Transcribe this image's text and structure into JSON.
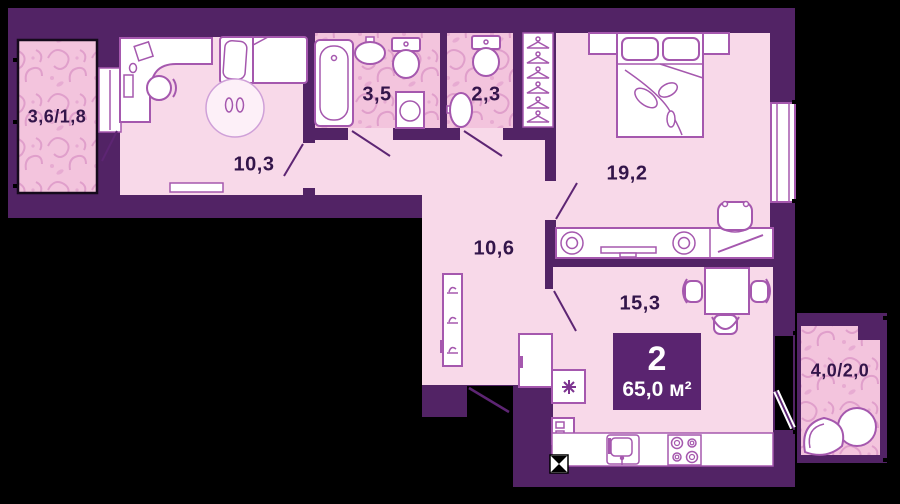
{
  "floorplan": {
    "badge": {
      "rooms_count": "2",
      "total_area": "65,0 м²"
    },
    "rooms": [
      {
        "name": "loggia-left",
        "area_label": "3,6/1,8"
      },
      {
        "name": "living-room",
        "area_label": "10,3"
      },
      {
        "name": "bathroom",
        "area_label": "3,5"
      },
      {
        "name": "toilet",
        "area_label": "2,3"
      },
      {
        "name": "bedroom",
        "area_label": "19,2"
      },
      {
        "name": "hallway",
        "area_label": "10,6"
      },
      {
        "name": "kitchen-living",
        "area_label": "15,3"
      },
      {
        "name": "balcony-right",
        "area_label": "4,0/2,0"
      }
    ],
    "colors": {
      "background": "#000000",
      "wall": "#522365",
      "floor": "#f8d9e9",
      "pattern_base": "#f3c4dd",
      "furniture_accent": "#a558ae",
      "badge": "#5a2470"
    }
  }
}
